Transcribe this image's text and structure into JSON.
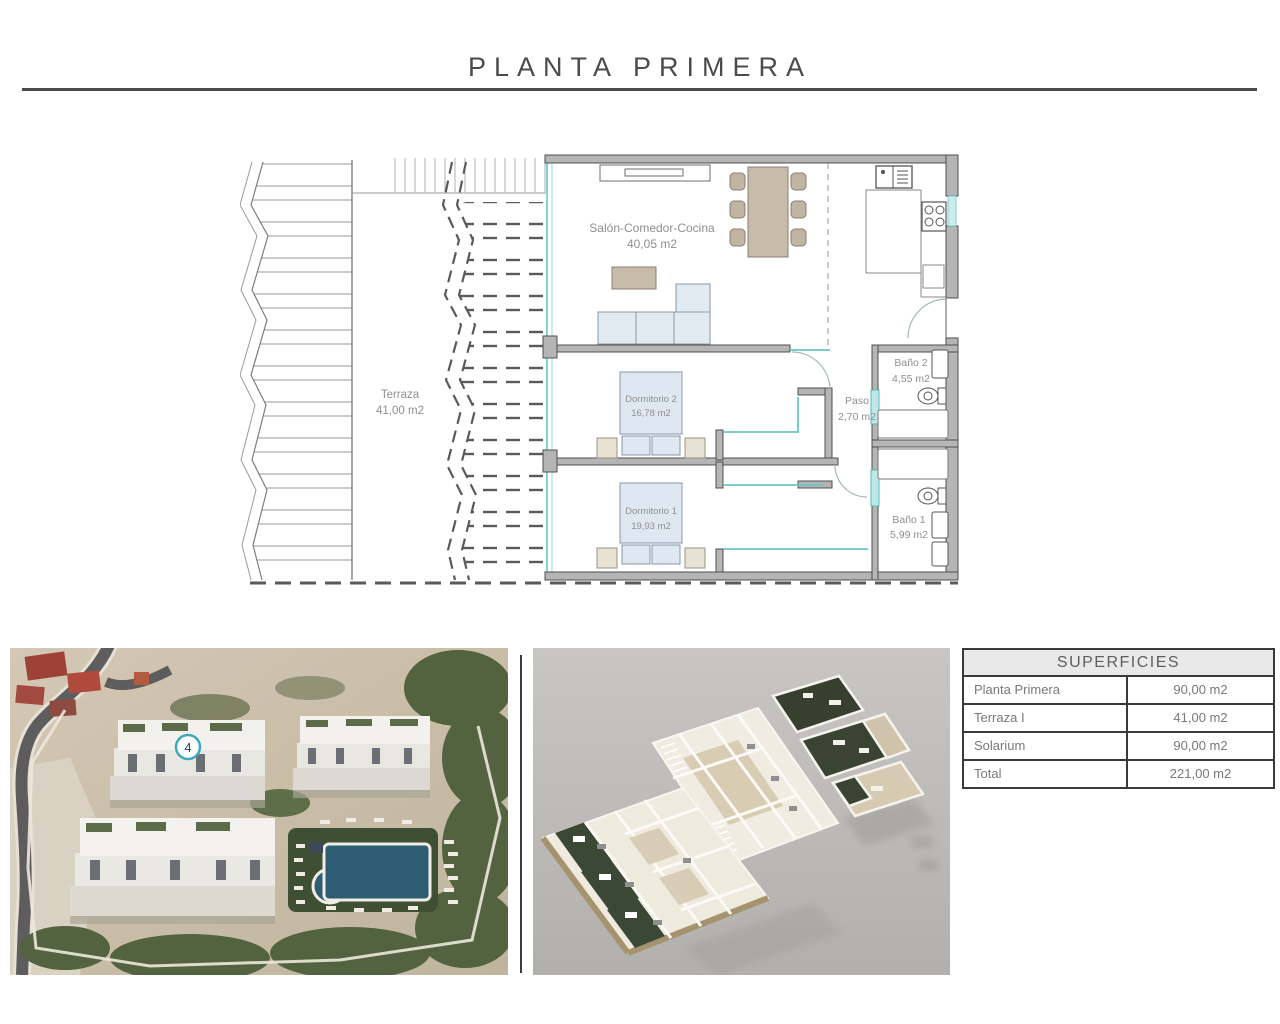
{
  "page": {
    "title": "PLANTA PRIMERA"
  },
  "floor_plan": {
    "rooms": [
      {
        "name": "Terraza",
        "area": "41,00 m2"
      },
      {
        "name": "Salón-Comedor-Cocina",
        "area": "40,05 m2"
      },
      {
        "name": "Dormitorio 2",
        "area": "16,78 m2"
      },
      {
        "name": "Dormitorio 1",
        "area": "19,93 m2"
      },
      {
        "name": "Paso",
        "area": "2,70 m2"
      },
      {
        "name": "Baño 2",
        "area": "4,55 m2"
      },
      {
        "name": "Baño 1",
        "area": "5,99 m2"
      }
    ]
  },
  "site_photo": {
    "unit_badge": "4"
  },
  "surfaces_table": {
    "header": "SUPERFICIES",
    "rows": [
      {
        "label": "Planta Primera",
        "value": "90,00 m2"
      },
      {
        "label": "Terraza I",
        "value": "41,00 m2"
      },
      {
        "label": "Solarium",
        "value": "90,00 m2"
      },
      {
        "label": "Total",
        "value": "221,00 m2"
      }
    ]
  },
  "colors": {
    "accent_teal": "#5fc0c4",
    "wall_gray": "#b5b5b5",
    "pool_blue": "#2e5d73",
    "rule_dark": "#4a4a4a"
  }
}
